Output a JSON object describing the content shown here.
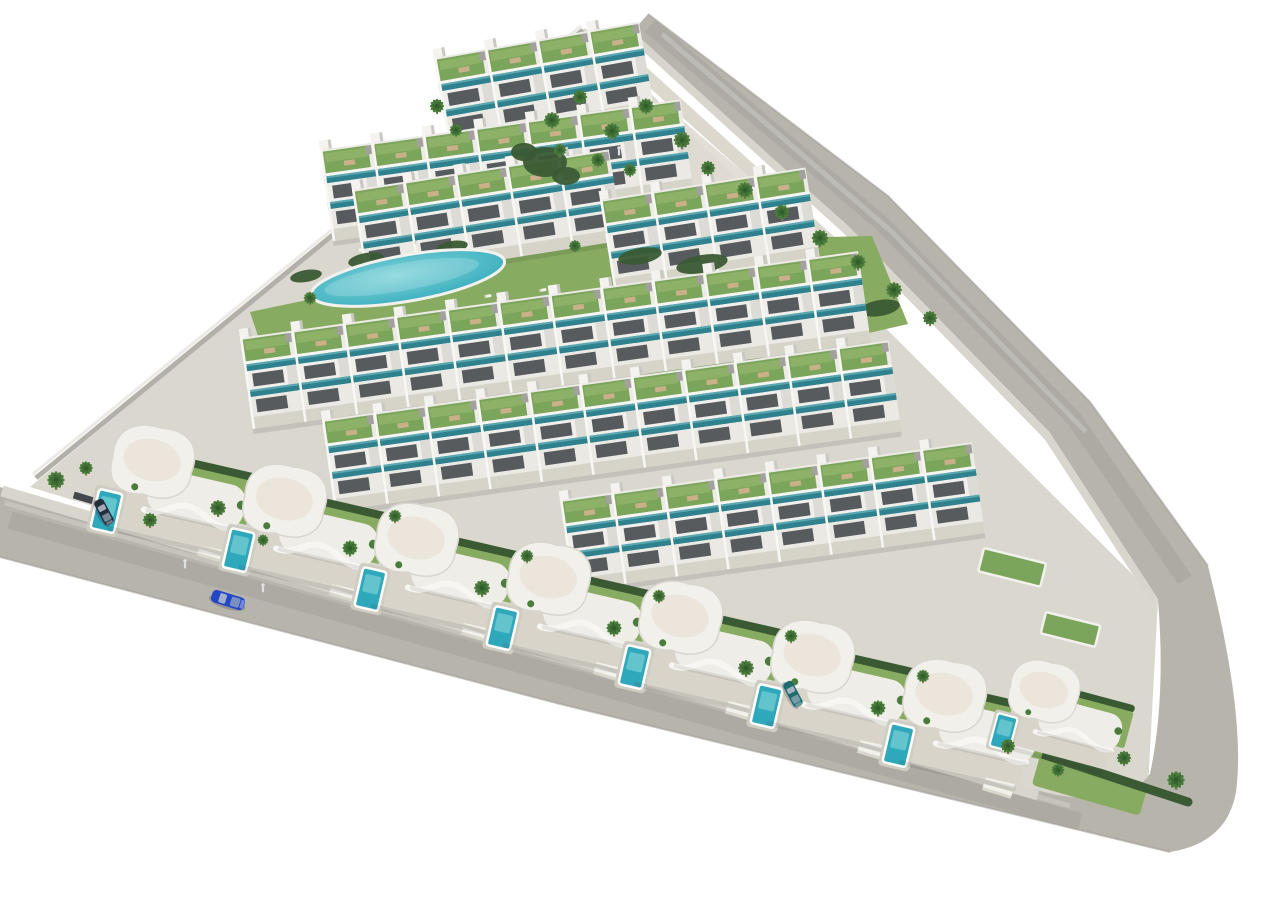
{
  "meta": {
    "description": "3D aerial architectural render of a triangular residential development plot bordered by two perimeter roads, with stepped rows of white terraced apartments (green roof terraces, teal glass balconies), a central lagoon-style pool and a round pool on a lawn, and a front row of white wave-roof villas each with a private turquoise pool",
    "image_type": "architectural-render",
    "visible_text": []
  },
  "colors": {
    "bg": "#ffffff",
    "ground": "#dad7ce",
    "plaza": "#e0dcd3",
    "road": "#b7b4ac",
    "sidewalk": "#d8d5cc",
    "curb": "#a29f98",
    "wall": "#b2b0a9",
    "lawn": "#87ab60",
    "hedge": "#3a5a34",
    "roof_green": "#7ca55c",
    "roof_green_light": "#8db167",
    "glass_teal": "#2f818e",
    "glass_teal_light": "#5aa7b0",
    "building_white": "#ecebe6",
    "building_trim": "#f6f5f2",
    "window": "#575b5e",
    "terrace": "#d6d3c9",
    "pool_mid": "#2fa8bb",
    "pool_light": "#7fd3d8",
    "palm": "#4a7c3c",
    "palm_dark": "#3d6b33",
    "trunk": "#8f7d63",
    "fence": "#44474b",
    "car_blue": "#2447c9",
    "car_navy": "#232e3e",
    "car_teal": "#1e6a71",
    "person": "#dfe2e4"
  },
  "scene": {
    "summary": {
      "apartment_row_count": 7,
      "villa_count": 8,
      "shared_pools": 2,
      "private_pools": 8,
      "vehicle_count": 3,
      "people_count": 3,
      "palm_tree_count": 38
    },
    "apartment_rows": [
      {
        "id": "apartment-row-a",
        "layer": "back",
        "x": 434,
        "y": 58,
        "rot": -10,
        "units": 4
      },
      {
        "id": "apartment-row-b",
        "layer": "back",
        "x": 320,
        "y": 150,
        "rot": -8,
        "units": 7
      },
      {
        "id": "apartment-row-c1",
        "layer": "back",
        "x": 352,
        "y": 190,
        "rot": -9,
        "units": 5
      },
      {
        "id": "apartment-row-c2",
        "layer": "back",
        "x": 600,
        "y": 200,
        "rot": -9,
        "units": 4
      },
      {
        "id": "apartment-row-d",
        "layer": "front",
        "x": 240,
        "y": 338,
        "rot": -8,
        "units": 12
      },
      {
        "id": "apartment-row-e",
        "layer": "front",
        "x": 322,
        "y": 420,
        "rot": -8,
        "units": 11
      },
      {
        "id": "apartment-row-f",
        "layer": "front",
        "x": 560,
        "y": 500,
        "rot": -8,
        "units": 8
      }
    ],
    "villas": {
      "style": "white curved wave parapet, beige terrace, rear lawn with hedge, private turquoise pool",
      "positions": [
        [
          113,
          412,
          13,
          1
        ],
        [
          245,
          451,
          13,
          1
        ],
        [
          377,
          490,
          13,
          1
        ],
        [
          509,
          529,
          13,
          1
        ],
        [
          641,
          568,
          13,
          1
        ],
        [
          773,
          607,
          13,
          1
        ],
        [
          905,
          646,
          13,
          1
        ],
        [
          1012,
          648,
          15,
          0.85
        ]
      ]
    },
    "pools": {
      "lagoon": {
        "cx": 408,
        "cy": 278,
        "rx": 98,
        "ry": 23,
        "rot": -10
      },
      "round": {
        "cx": 676,
        "cy": 314,
        "rx": 31,
        "ry": 12.5,
        "rot": -10
      },
      "corner": {
        "x": 1096,
        "y": 784,
        "w": 44,
        "h": 17,
        "rot": 16
      }
    },
    "hedges": [
      [
        640,
        256,
        22,
        8,
        -10
      ],
      [
        702,
        264,
        26,
        9,
        -10
      ],
      [
        764,
        278,
        26,
        9,
        -10
      ],
      [
        826,
        294,
        24,
        9,
        -10
      ],
      [
        880,
        308,
        20,
        8,
        -10
      ],
      [
        366,
        260,
        18,
        7,
        -10
      ],
      [
        306,
        276,
        16,
        6,
        -10
      ],
      [
        452,
        247,
        16,
        6,
        -10
      ],
      [
        545,
        162,
        22,
        15,
        0
      ],
      [
        566,
        176,
        14,
        9,
        0
      ],
      [
        524,
        152,
        13,
        9,
        0
      ]
    ],
    "loungers": [
      [
        488,
        296
      ],
      [
        500,
        300
      ],
      [
        543,
        290
      ],
      [
        360,
        250
      ],
      [
        418,
        242
      ],
      [
        620,
        330
      ],
      [
        643,
        334
      ],
      [
        706,
        326
      ],
      [
        648,
        302
      ]
    ],
    "palms": [
      [
        552,
        120,
        1
      ],
      [
        580,
        97,
        0.9
      ],
      [
        612,
        131,
        1
      ],
      [
        646,
        106,
        0.95
      ],
      [
        682,
        140,
        1.05
      ],
      [
        708,
        168,
        0.9
      ],
      [
        745,
        190,
        1
      ],
      [
        782,
        212,
        0.95
      ],
      [
        820,
        238,
        1.05
      ],
      [
        858,
        262,
        0.95
      ],
      [
        894,
        290,
        1
      ],
      [
        930,
        318,
        0.9
      ],
      [
        560,
        150,
        0.8
      ],
      [
        598,
        160,
        0.85
      ],
      [
        630,
        170,
        0.8
      ],
      [
        437,
        106,
        0.9
      ],
      [
        456,
        130,
        0.8
      ],
      [
        56,
        480,
        1.1
      ],
      [
        86,
        468,
        0.85
      ],
      [
        150,
        520,
        0.9
      ],
      [
        310,
        298,
        0.8
      ],
      [
        575,
        246,
        0.75
      ],
      [
        218,
        508,
        1
      ],
      [
        350,
        548,
        0.95
      ],
      [
        482,
        588,
        1
      ],
      [
        614,
        628,
        0.95
      ],
      [
        746,
        668,
        1
      ],
      [
        878,
        708,
        0.95
      ],
      [
        1008,
        746,
        0.9
      ],
      [
        395,
        516,
        0.8
      ],
      [
        527,
        556,
        0.8
      ],
      [
        659,
        596,
        0.8
      ],
      [
        791,
        636,
        0.8
      ],
      [
        923,
        676,
        0.8
      ],
      [
        1176,
        780,
        1.1
      ],
      [
        1124,
        758,
        0.9
      ],
      [
        1058,
        770,
        0.8
      ],
      [
        263,
        540,
        0.7
      ]
    ],
    "fences": {
      "x0": 90,
      "x1": 1020,
      "step": 65,
      "base_x": 30,
      "base_y": 490,
      "slope": 0.299,
      "dy": -8
    },
    "driveways": [
      215,
      347,
      479,
      611,
      743,
      875,
      1000
    ],
    "vehicles": [
      {
        "name": "car-blue-driving",
        "x": 228,
        "y": 600,
        "rot": 17,
        "scale": 1,
        "color_key": "car_blue"
      },
      {
        "name": "car-navy-parked",
        "x": 104,
        "y": 512,
        "rot": 62,
        "scale": 0.8,
        "color_key": "car_navy"
      },
      {
        "name": "car-teal-parked",
        "x": 793,
        "y": 694,
        "rot": 62,
        "scale": 0.8,
        "color_key": "car_teal"
      }
    ],
    "people": [
      [
        185,
        565
      ],
      [
        263,
        589
      ],
      [
        619,
        152
      ]
    ],
    "green_patches": [
      [
        984,
        548,
        64,
        24,
        14
      ],
      [
        1046,
        612,
        56,
        22,
        14
      ]
    ]
  }
}
